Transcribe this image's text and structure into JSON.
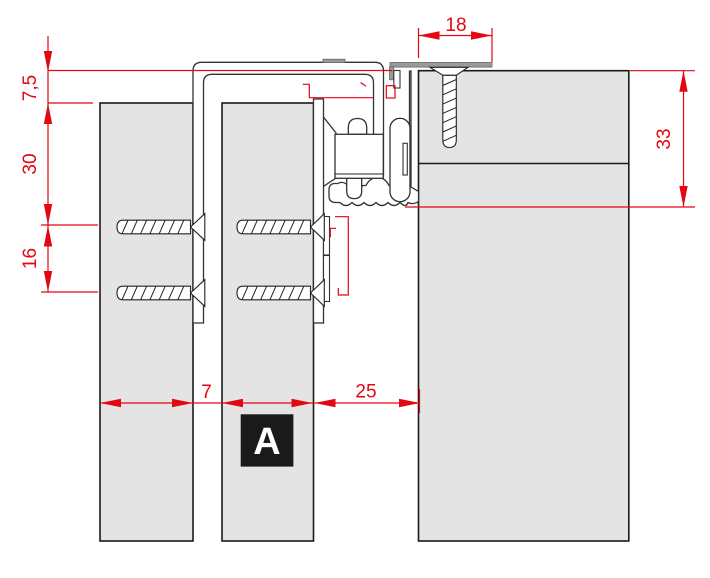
{
  "drawing": {
    "title": "sliding panel top rail cross-section",
    "detail_marker": {
      "label": "A"
    },
    "dimensions": {
      "top_width": "18",
      "left_offset": "7,5",
      "left_upper_spacing": "30",
      "left_lower_spacing": "16",
      "right_height": "33",
      "bottom_gap": "7",
      "bottom_clearance": "25"
    },
    "colors": {
      "dimension_red": "#e30613",
      "panel_gray": "#e4e4e4",
      "outline_black": "#1a1a1a",
      "profile_gray": "#9a9a9a",
      "background": "#ffffff"
    }
  }
}
